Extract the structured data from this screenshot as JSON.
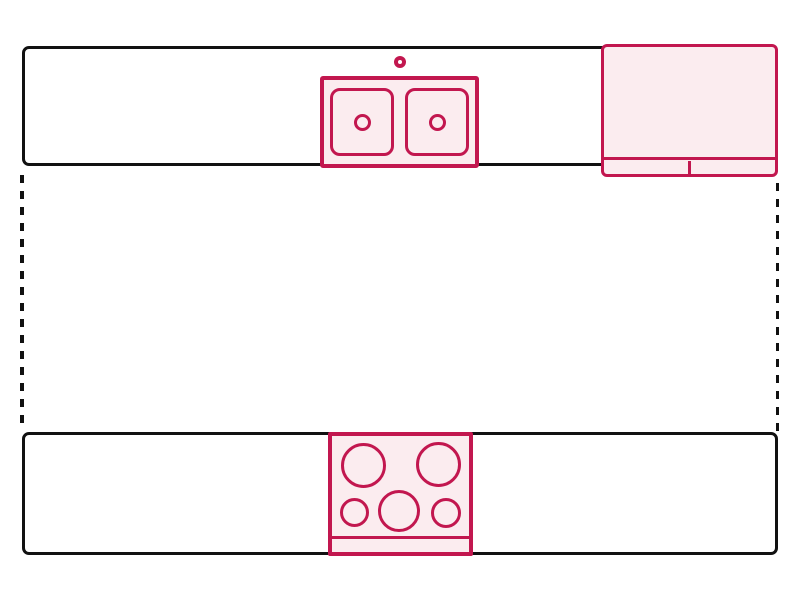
{
  "diagram": {
    "type": "kitchen-floor-plan",
    "elements": {
      "top_counter": {
        "name": "countertop-top-run"
      },
      "refrigerator": {
        "name": "refrigerator"
      },
      "sink": {
        "name": "double-basin-sink"
      },
      "faucet": {
        "name": "faucet"
      },
      "walkway_left": {
        "name": "open-side-left-dashed"
      },
      "walkway_right": {
        "name": "open-side-right-dashed"
      },
      "bottom_counter": {
        "name": "countertop-bottom-run"
      },
      "cooktop": {
        "name": "five-burner-cooktop"
      }
    },
    "counts": {
      "sink_basins": 2,
      "cooktop_burners": 5
    }
  },
  "colors": {
    "accent": "#c2174f",
    "accent_fill": "#fbecef",
    "outline": "#111111",
    "background": "#ffffff"
  }
}
